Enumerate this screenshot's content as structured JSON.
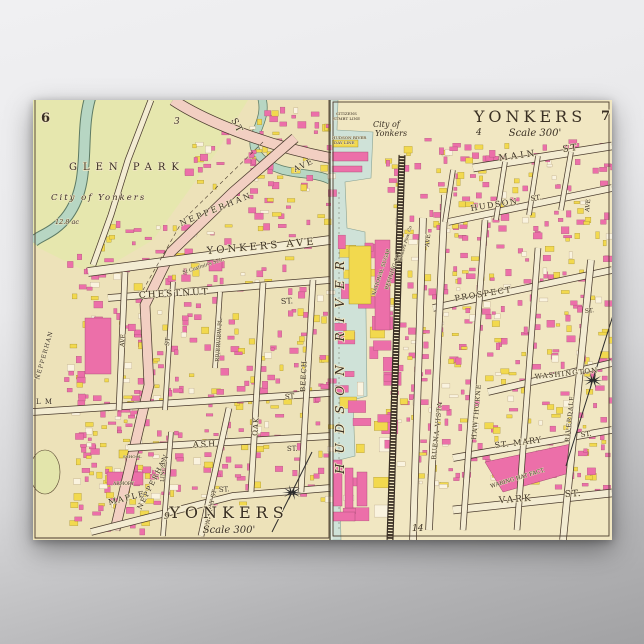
{
  "poster": {
    "background": {
      "top_color": "#f0f0f2",
      "bottom_color": "#a2a2a4"
    },
    "paper_color": "#f0e6c0",
    "palette": {
      "building_pink": "#ec6fa9",
      "building_yellow": "#f2d94e",
      "building_white": "#faf3df",
      "park_green": "#e6e7ae",
      "river_teal": "#b7d6c3",
      "water_blue": "#cfe2d8",
      "road_cream": "#f3ecd2",
      "road_pink": "#f2cfc2",
      "line_dark": "#4a3b2d"
    },
    "labels": [
      {
        "id": "page-6",
        "text": "6",
        "x": 8,
        "y": 22,
        "s": 13,
        "w": "bold"
      },
      {
        "id": "glen-park",
        "text": "GLEN  PARK",
        "x": 36,
        "y": 70,
        "s": 10,
        "ls": 6
      },
      {
        "id": "city-of-yonkers-left",
        "text": "City of Yonkers",
        "x": 18,
        "y": 100,
        "s": 8.5,
        "it": 1,
        "ls": 2
      },
      {
        "id": "acreage",
        "text": "12.8 ac",
        "x": 22,
        "y": 124,
        "s": 6.5,
        "it": 1
      },
      {
        "id": "block-3",
        "text": "3",
        "x": 141,
        "y": 24,
        "s": 9,
        "it": 1
      },
      {
        "id": "st-top",
        "text": "ST",
        "x": 198,
        "y": 20,
        "s": 9,
        "rot": 62,
        "ls": 2
      },
      {
        "id": "nepperhan-ave",
        "text": "NEPPERHAN",
        "x": 148,
        "y": 126,
        "s": 8,
        "rot": -22,
        "ls": 2.5
      },
      {
        "id": "nepperhan-ave-2",
        "text": "AVE",
        "x": 262,
        "y": 72,
        "s": 8,
        "rot": -25,
        "ls": 1.5
      },
      {
        "id": "yonkers-ave",
        "text": "YONKERS AVE",
        "x": 174,
        "y": 154,
        "s": 10,
        "rot": -5,
        "ls": 3
      },
      {
        "id": "chestnut-st",
        "text": "CHESTNUT",
        "x": 106,
        "y": 198,
        "s": 9,
        "rot": -3,
        "ls": 2
      },
      {
        "id": "chestnut-st-2",
        "text": "ST.",
        "x": 248,
        "y": 204,
        "s": 8,
        "rot": -3
      },
      {
        "id": "riverview-pl",
        "text": "RIVERVIEW PL.",
        "x": 186,
        "y": 262,
        "s": 5.5,
        "rot": -86
      },
      {
        "id": "beech-st",
        "text": "BEECH",
        "x": 272,
        "y": 292,
        "s": 7,
        "rot": -87,
        "ls": 1
      },
      {
        "id": "oak-st",
        "text": "OAK",
        "x": 224,
        "y": 336,
        "s": 7,
        "rot": -85,
        "ls": 1
      },
      {
        "id": "st-vert-mid",
        "text": "ST",
        "x": 136,
        "y": 246,
        "s": 6,
        "rot": -86
      },
      {
        "id": "ave-vert-left",
        "text": "AVE",
        "x": 91,
        "y": 247,
        "s": 6,
        "rot": -86
      },
      {
        "id": "elm-st",
        "text": "L M",
        "x": 3,
        "y": 304,
        "s": 7,
        "ls": 1
      },
      {
        "id": "elm-st-2",
        "text": "ST",
        "x": 252,
        "y": 299,
        "s": 7,
        "rot": -3
      },
      {
        "id": "ash-st",
        "text": "ASH",
        "x": 160,
        "y": 347,
        "s": 8,
        "rot": -2,
        "ls": 2
      },
      {
        "id": "ash-st-2",
        "text": "ST.",
        "x": 254,
        "y": 351,
        "s": 7,
        "rot": -2
      },
      {
        "id": "maple-st",
        "text": "MAPLE",
        "x": 76,
        "y": 405,
        "s": 8,
        "rot": -14,
        "ls": 1.5
      },
      {
        "id": "maple-st-2",
        "text": "ST.",
        "x": 186,
        "y": 392,
        "s": 7,
        "rot": -4
      },
      {
        "id": "linden-st",
        "text": "LINDEN",
        "x": 131,
        "y": 382,
        "s": 5.5,
        "rot": -87
      },
      {
        "id": "waverly-st",
        "text": "WAVERLY ST",
        "x": 175,
        "y": 430,
        "s": 6,
        "rot": -78
      },
      {
        "id": "nepperhan-lower",
        "text": "NEPPERHAN",
        "x": 108,
        "y": 410,
        "s": 7,
        "rot": -63,
        "ls": 1.5
      },
      {
        "id": "nepperhan-left-edge",
        "text": "NEPPERHAN",
        "x": 6,
        "y": 280,
        "s": 6,
        "rot": -74,
        "ls": 1
      },
      {
        "id": "st-casimirs",
        "text": "St Casimir's Sch.",
        "x": 150,
        "y": 174,
        "s": 5,
        "it": 1,
        "rot": -18
      },
      {
        "id": "armory",
        "text": "ARMORY",
        "x": 80,
        "y": 385,
        "s": 4.5
      },
      {
        "id": "school",
        "text": "SCHOOL",
        "x": 90,
        "y": 358,
        "s": 4
      },
      {
        "id": "yonkers-title-left",
        "text": "YONKERS",
        "x": 196,
        "y": 418,
        "s": 16,
        "ls": 5,
        "anchor": "middle"
      },
      {
        "id": "scale-left",
        "text": "Scale 300'",
        "x": 196,
        "y": 433,
        "s": 10,
        "it": 1,
        "anchor": "middle"
      },
      {
        "id": "page-9",
        "text": "9",
        "x": 131,
        "y": 419,
        "s": 9,
        "it": 1
      },
      {
        "id": "yonkers-title-right",
        "text": "YONKERS",
        "x": 497,
        "y": 22,
        "s": 16,
        "ls": 4,
        "anchor": "middle"
      },
      {
        "id": "page-4",
        "text": "4",
        "x": 443,
        "y": 35,
        "s": 9,
        "it": 1
      },
      {
        "id": "scale-right",
        "text": "Scale 300'",
        "x": 502,
        "y": 36,
        "s": 10,
        "it": 1,
        "anchor": "middle"
      },
      {
        "id": "page-7",
        "text": "7",
        "x": 568,
        "y": 20,
        "s": 13,
        "w": "bold"
      },
      {
        "id": "main-st",
        "text": "MAIN",
        "x": 466,
        "y": 61,
        "s": 9,
        "rot": -8,
        "ls": 3
      },
      {
        "id": "main-st-2",
        "text": "ST",
        "x": 530,
        "y": 52,
        "s": 9,
        "rot": -8,
        "ls": 2
      },
      {
        "id": "hudson-st",
        "text": "HUDSON",
        "x": 438,
        "y": 111,
        "s": 8,
        "rot": -9,
        "ls": 1.5
      },
      {
        "id": "hudson-st-2",
        "text": "ST.",
        "x": 498,
        "y": 101,
        "s": 7,
        "rot": -9
      },
      {
        "id": "prospect-st",
        "text": "PROSPECT",
        "x": 422,
        "y": 201,
        "s": 8,
        "rot": -9,
        "ls": 1.5
      },
      {
        "id": "washington-st",
        "text": "WASHINGTON",
        "x": 502,
        "y": 279,
        "s": 7,
        "rot": -6,
        "ls": 1
      },
      {
        "id": "st-mary-st",
        "text": "ST. MARY",
        "x": 462,
        "y": 348,
        "s": 8,
        "rot": -7,
        "ls": 1
      },
      {
        "id": "st-mary-st-2",
        "text": "ST.",
        "x": 548,
        "y": 337,
        "s": 7,
        "rot": -7
      },
      {
        "id": "vark-st",
        "text": "VARK",
        "x": 466,
        "y": 403,
        "s": 9,
        "rot": -4,
        "ls": 2
      },
      {
        "id": "vark-st-2",
        "text": "ST.",
        "x": 532,
        "y": 397,
        "s": 9,
        "rot": -4,
        "ls": 1
      },
      {
        "id": "waring-hat",
        "text": "WARING HAT FACT.",
        "x": 458,
        "y": 388,
        "s": 5.5,
        "rot": -17
      },
      {
        "id": "hudson-river",
        "text": "HUDSON RIVER",
        "x": 311,
        "y": 374,
        "s": 12,
        "rot": -90,
        "it": 1,
        "ls": 10
      },
      {
        "id": "citizens-line-1",
        "text": "CITIZENS",
        "x": 303,
        "y": 15,
        "s": 4
      },
      {
        "id": "citizens-line-2",
        "text": "STMBT LINE",
        "x": 300,
        "y": 20,
        "s": 4
      },
      {
        "id": "day-line-1",
        "text": "HUDSON RIVER",
        "x": 299,
        "y": 39,
        "s": 4
      },
      {
        "id": "day-line-2",
        "text": "DAY LINE",
        "x": 301,
        "y": 44,
        "s": 4
      },
      {
        "id": "city-of-yonkers-right-1",
        "text": "City of",
        "x": 340,
        "y": 27,
        "s": 8,
        "it": 1
      },
      {
        "id": "city-of-yonkers-right-2",
        "text": "Yonkers",
        "x": 342,
        "y": 36,
        "s": 8,
        "it": 1
      },
      {
        "id": "national-sugar-1",
        "text": "NATIONAL SUGAR",
        "x": 342,
        "y": 196,
        "s": 5,
        "rot": -72
      },
      {
        "id": "national-sugar-2",
        "text": "REFINING CO",
        "x": 355,
        "y": 190,
        "s": 5,
        "rot": -72
      },
      {
        "id": "yonkers-power",
        "text": "Yonkers Pow. Co",
        "x": 368,
        "y": 162,
        "s": 4.5,
        "rot": -73,
        "it": 1
      },
      {
        "id": "buena-vista-ave",
        "text": "BUENA VISTA",
        "x": 403,
        "y": 360,
        "s": 6.5,
        "rot": -84,
        "ls": 1
      },
      {
        "id": "hawthorne-ave",
        "text": "HAWTHORNE",
        "x": 443,
        "y": 340,
        "s": 6.5,
        "rot": -85,
        "ls": 1
      },
      {
        "id": "riverdale-ave",
        "text": "RIVERDALE",
        "x": 536,
        "y": 342,
        "s": 6,
        "rot": -84,
        "ls": 1
      },
      {
        "id": "ave-warburton",
        "text": "AVE",
        "x": 396,
        "y": 147,
        "s": 6,
        "rot": -84
      },
      {
        "id": "ave-right-edge",
        "text": "AVE",
        "x": 556,
        "y": 112,
        "s": 6,
        "rot": -84
      },
      {
        "id": "st-right-edge",
        "text": "ST.",
        "x": 552,
        "y": 213,
        "s": 6,
        "rot": -6
      },
      {
        "id": "page-14",
        "text": "14",
        "x": 379,
        "y": 431,
        "s": 9,
        "it": 1
      }
    ]
  }
}
